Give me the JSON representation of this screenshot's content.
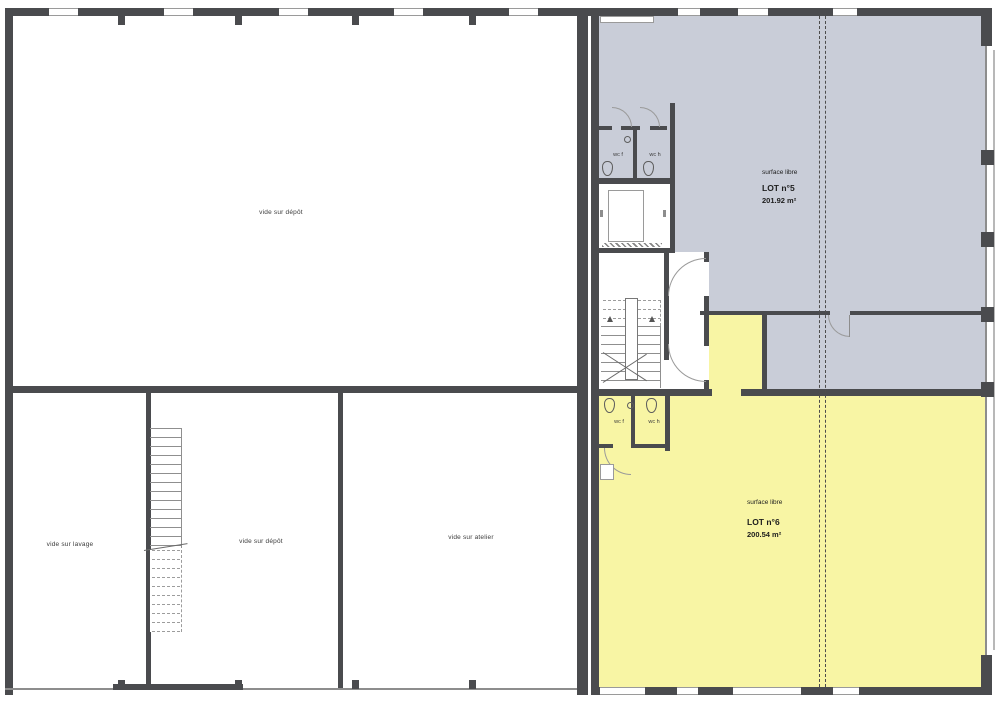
{
  "colors": {
    "wall": "#4a4b4e",
    "lot5_fill": "#c9cdd8",
    "lot6_fill": "#f8f5a4"
  },
  "left_wing": {
    "room_top": "vide sur dépôt",
    "room_bottom_left": "vide sur lavage",
    "room_bottom_middle": "vide sur dépôt",
    "room_bottom_right": "vide sur atelier"
  },
  "right_wing": {
    "lot5": {
      "surface": "surface libre",
      "name": "LOT n°5",
      "area": "201.92 m²"
    },
    "lot6": {
      "surface": "surface libre",
      "name": "LOT n°6",
      "area": "200.54 m²"
    },
    "wc_top": {
      "left": "wc f",
      "right": "wc h"
    },
    "wc_bottom": {
      "left": "wc f",
      "right": "wc h"
    }
  }
}
